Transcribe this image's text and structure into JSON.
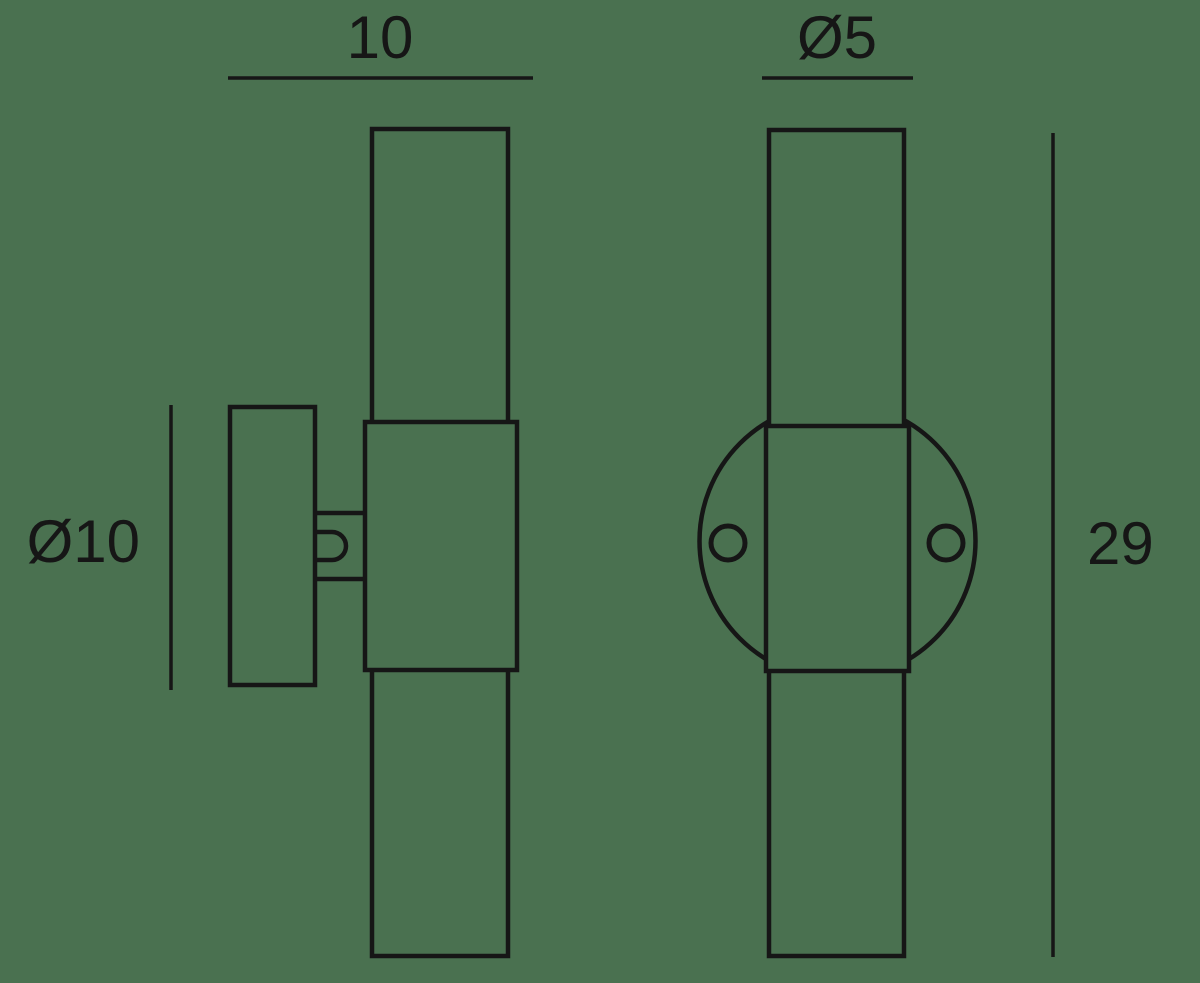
{
  "theme": {
    "background_color": "#4a7150",
    "line_color": "#161616"
  },
  "drawing": {
    "description": "wall-light-technical-drawing",
    "dimensions": {
      "top_width": {
        "label": "10"
      },
      "tube_diameter": {
        "label": "Ø5"
      },
      "plate_diameter": {
        "label": "Ø10"
      },
      "overall_height": {
        "label": "29"
      }
    }
  }
}
